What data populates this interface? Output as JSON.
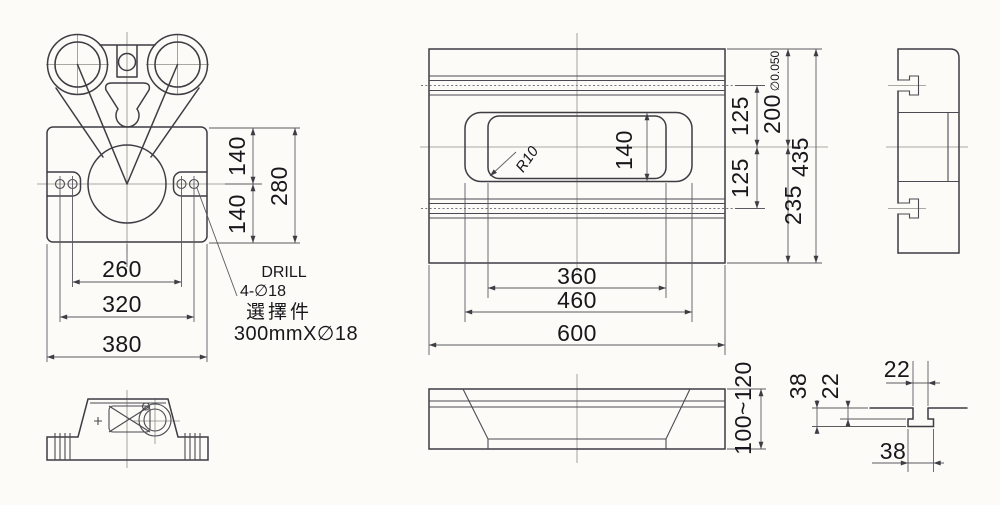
{
  "title": "Machine base engineering drawing",
  "colors": {
    "background": "#fcfbf7",
    "outline": "#3d3d44",
    "dimension_line": "#5b5b62",
    "centerline": "#8f8f85",
    "text": "#17171c"
  },
  "front_view": {
    "dims": {
      "upper_half": "140",
      "lower_half": "140",
      "total_height": "280",
      "inner_hole_span": "260",
      "outer_hole_span": "320",
      "base_width": "380"
    },
    "notes": {
      "drill_label": "DRILL",
      "drill_holes": "4-∅18",
      "option_label": "選擇件",
      "option_spec": "300mmX∅18"
    }
  },
  "plan_view": {
    "dims": {
      "slot_height": "140",
      "upper_offset": "125",
      "lower_offset": "125",
      "top_to_center": "200",
      "tolerance": "∅0.050",
      "center_to_bottom": "235",
      "total_depth": "435",
      "inner_slot_width": "360",
      "recess_width": "460",
      "total_width": "600"
    },
    "notes": {
      "corner_radius": "R10"
    }
  },
  "side_elevation": {
    "dims": {
      "thickness": "100~120"
    }
  },
  "tslot_detail": {
    "dims": {
      "slot_width": "22",
      "tee_width": "38",
      "slot_depth": "22",
      "tee_depth": "38"
    }
  }
}
